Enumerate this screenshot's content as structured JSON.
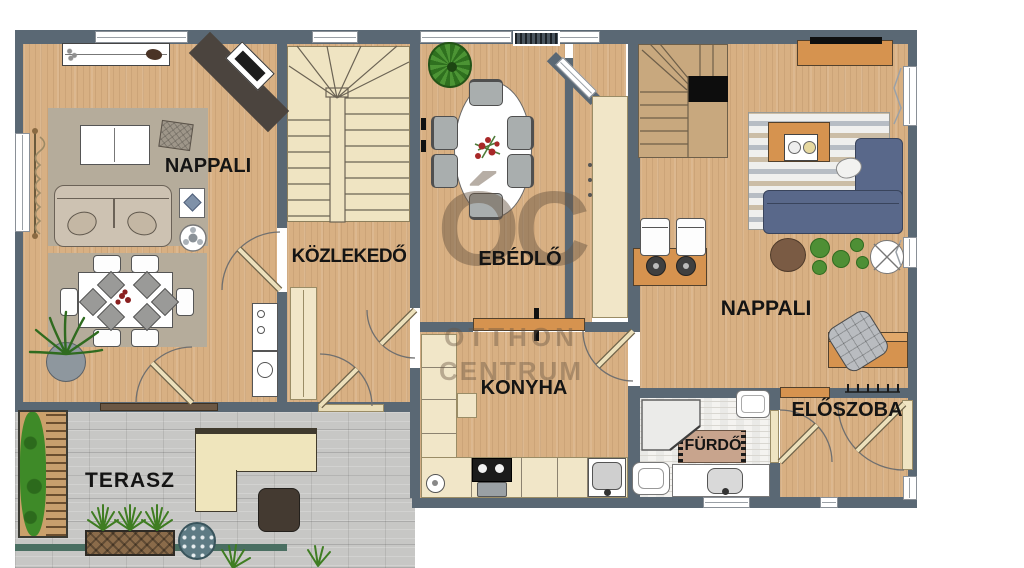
{
  "floorplan": {
    "rooms": {
      "living_left": {
        "label": "NAPPALI"
      },
      "hallway": {
        "label": "KÖZLEKEDŐ"
      },
      "dining": {
        "label": "EBÉDLŐ"
      },
      "kitchen": {
        "label": "KONYHA"
      },
      "living_right": {
        "label": "NAPPALI"
      },
      "entry": {
        "label": "ELŐSZOBA"
      },
      "bathroom": {
        "label": "FÜRDŐ"
      },
      "terrace": {
        "label": "TERASZ"
      }
    },
    "watermark": {
      "monogram": "ÓC",
      "name_line1": "OTTHON",
      "name_line2": "CENTRUM"
    },
    "colors": {
      "wall": "#5a6874",
      "wood_floor": "#d8b083",
      "stair_cream": "#efe4c2",
      "terrace_paving": "#c7c7c5",
      "accent_orange": "#d6934f",
      "sofa_blue": "#59688a",
      "hedge_green": "#3e8a28",
      "watermark_brown": "#685642"
    }
  }
}
